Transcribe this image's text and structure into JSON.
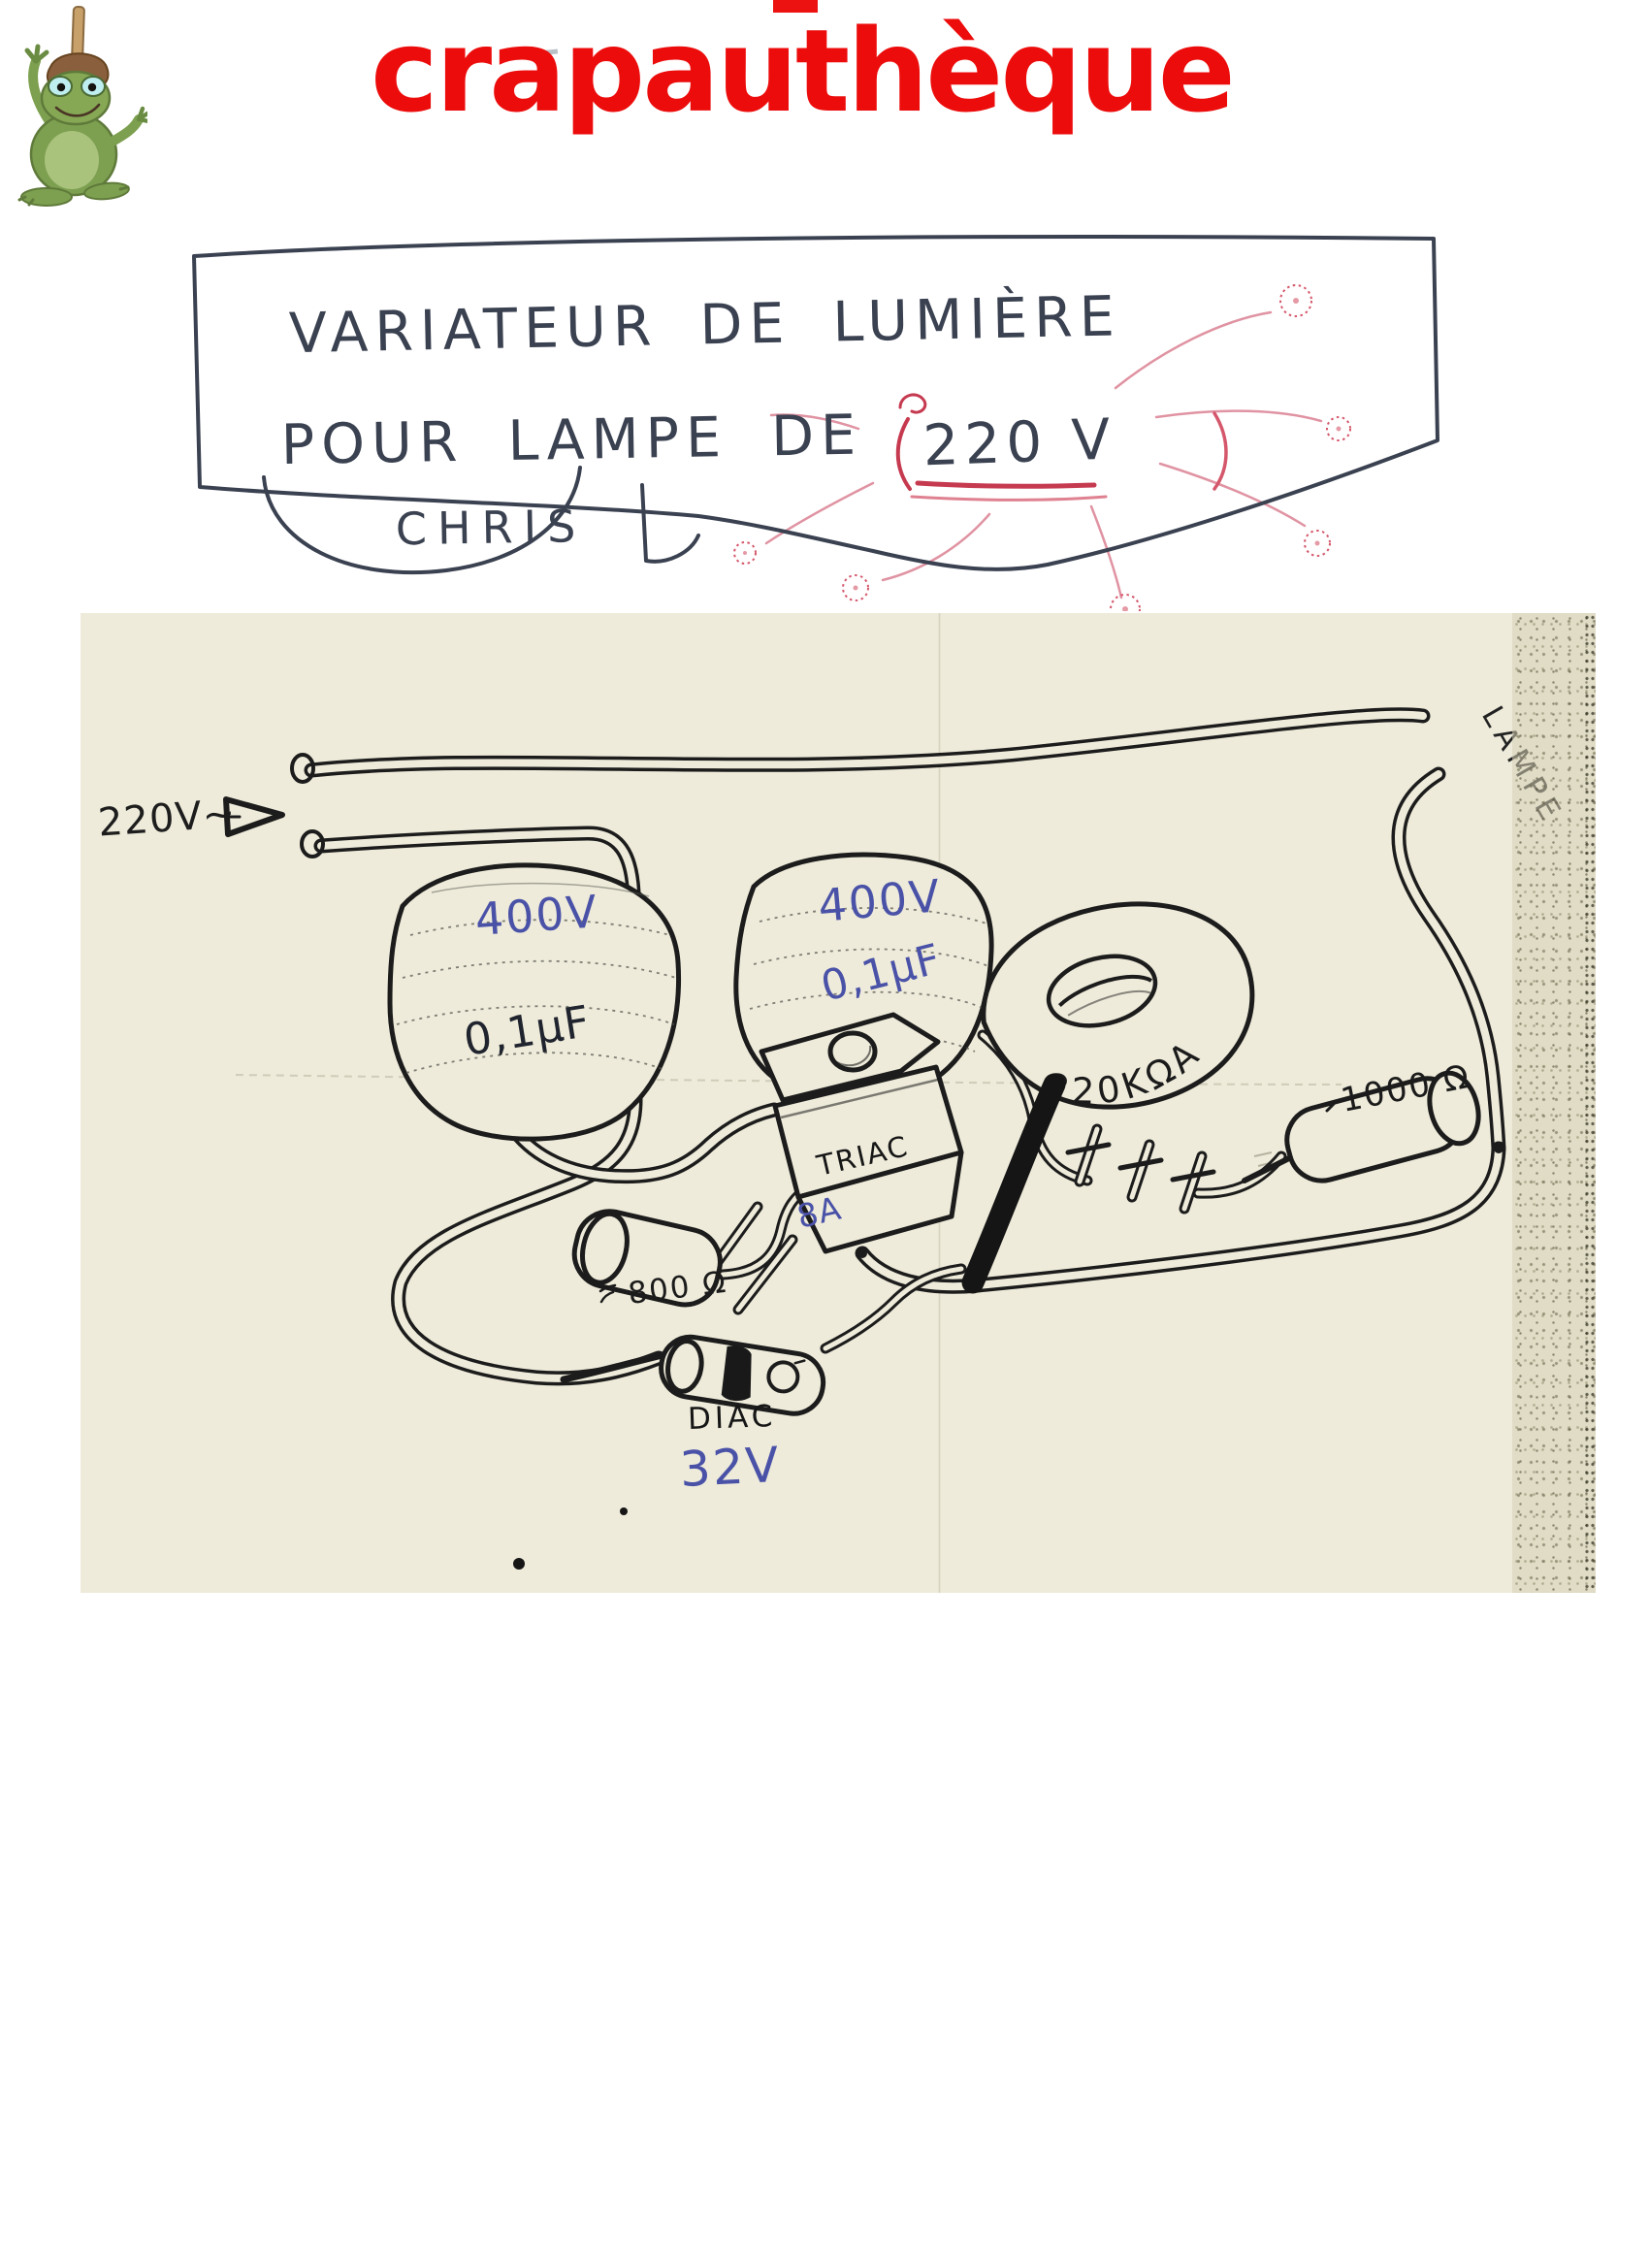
{
  "header": {
    "site_title": "crapauthèque",
    "logo_alt": "frog-with-plunger-mascot",
    "accent_red": "#ec0c0c"
  },
  "sketch": {
    "line1": "VARIATEUR DE LUMIÈRE",
    "line2_prefix": "POUR LAMPE DE",
    "line2_voltage": "220 V",
    "signature": "CHRIS",
    "ink_color": "#3a4150",
    "highlight_red": "#c63a50"
  },
  "circuit": {
    "paper_color": "#eeebda",
    "ink_color": "#1c1c1c",
    "annotation_blue": "#4a52a8",
    "input_label": "220V~",
    "lamp_label": "LAMPE",
    "capacitor1": {
      "voltage": "400V",
      "value": "0,1µF"
    },
    "capacitor2": {
      "voltage": "400V",
      "value": "0,1µF"
    },
    "potentiometer": {
      "value": "220KΩA"
    },
    "resistor1": {
      "value": "1000 Ω"
    },
    "resistor2": {
      "value": "800 Ω"
    },
    "triac": {
      "name": "TRIAC",
      "rating": "8A"
    },
    "diac": {
      "name": "DIAC",
      "voltage": "32V"
    }
  }
}
